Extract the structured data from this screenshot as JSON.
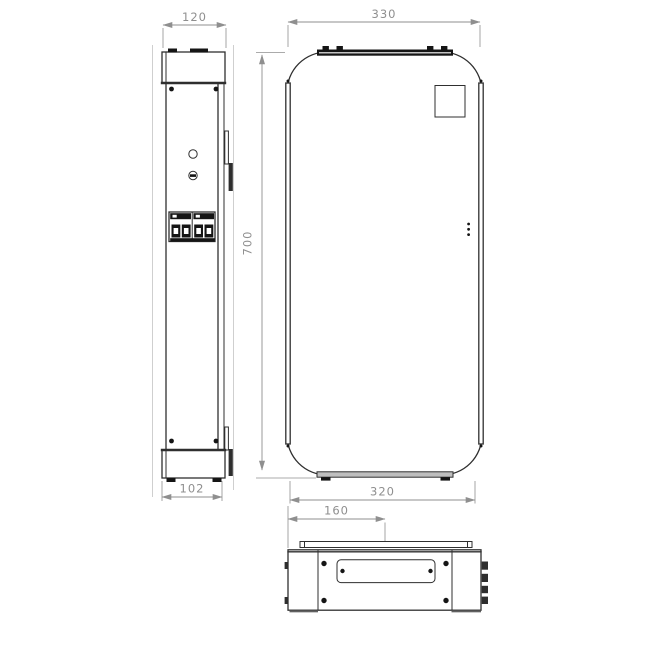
{
  "colors": {
    "background": "#ffffff",
    "part_line": "#2f2f2f",
    "part_fill_dark": "#151515",
    "dimension": "#8f8f8f"
  },
  "dimensions": {
    "side_top_width": "120",
    "side_bottom_depth": "102",
    "front_top_width": "330",
    "front_height": "700",
    "front_bottom_width": "320",
    "bottom_gland_offset": "160"
  }
}
